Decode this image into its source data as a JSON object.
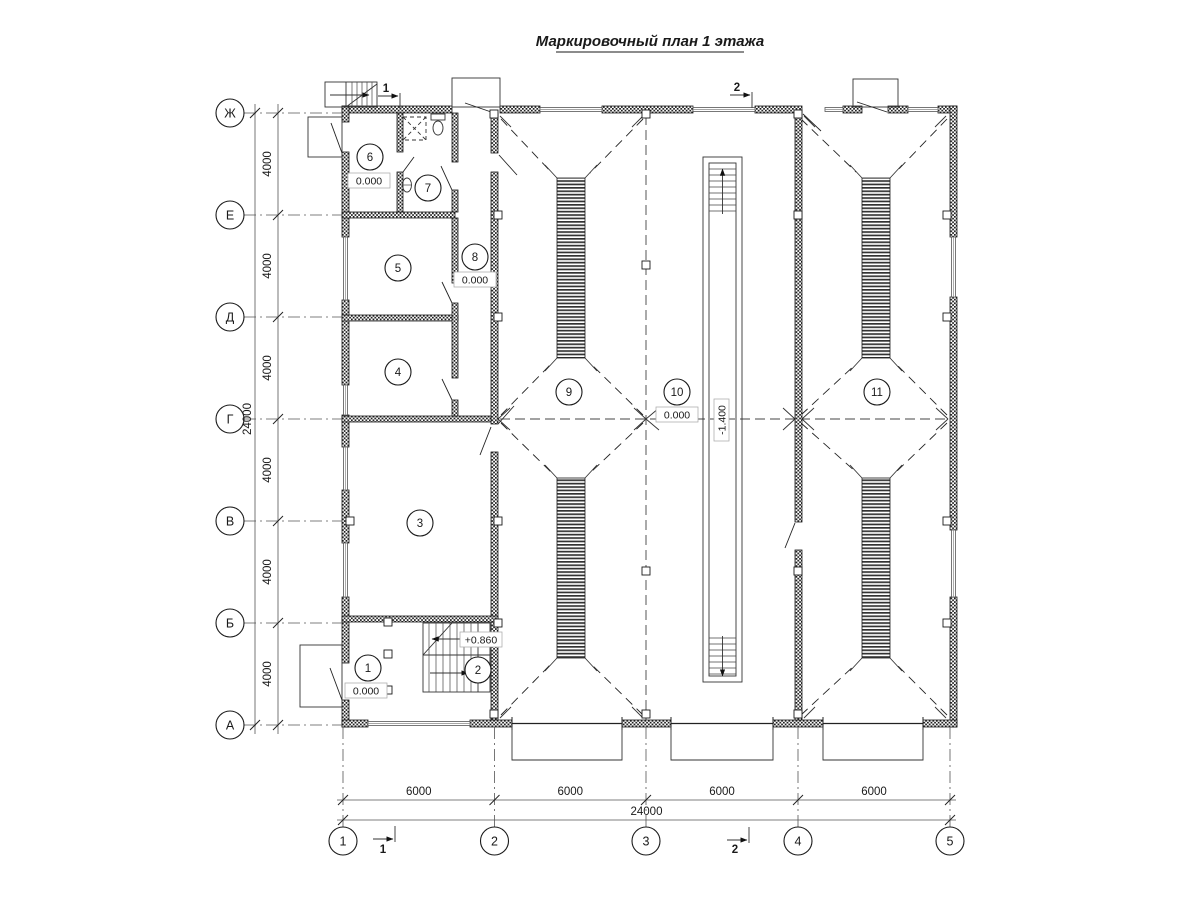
{
  "palette": {
    "ink": "#1a1a1a",
    "background": "#ffffff"
  },
  "title": "Маркировочный план 1 этажа",
  "grid": {
    "row_axes": [
      {
        "label": "Ж",
        "y": 113
      },
      {
        "label": "Е",
        "y": 215
      },
      {
        "label": "Д",
        "y": 317
      },
      {
        "label": "Г",
        "y": 419
      },
      {
        "label": "В",
        "y": 521
      },
      {
        "label": "Б",
        "y": 623
      },
      {
        "label": "А",
        "y": 725
      }
    ],
    "col_axes": [
      {
        "label": "1",
        "x": 343
      },
      {
        "label": "2",
        "x": 494.5
      },
      {
        "label": "3",
        "x": 646
      },
      {
        "label": "4",
        "x": 798
      },
      {
        "label": "5",
        "x": 950
      }
    ]
  },
  "dimensions": {
    "left_segments": [
      "4000",
      "4000",
      "4000",
      "4000",
      "4000",
      "4000"
    ],
    "left_total": "24000",
    "bottom_segments": [
      "6000",
      "6000",
      "6000",
      "6000"
    ],
    "bottom_total": "24000"
  },
  "rooms": [
    {
      "number": "1",
      "x": 368,
      "y": 668
    },
    {
      "number": "2",
      "x": 478,
      "y": 670
    },
    {
      "number": "3",
      "x": 420,
      "y": 523
    },
    {
      "number": "4",
      "x": 398,
      "y": 372
    },
    {
      "number": "5",
      "x": 398,
      "y": 268
    },
    {
      "number": "6",
      "x": 370,
      "y": 157
    },
    {
      "number": "7",
      "x": 428,
      "y": 188
    },
    {
      "number": "8",
      "x": 475,
      "y": 257
    },
    {
      "number": "9",
      "x": 569,
      "y": 392
    },
    {
      "number": "10",
      "x": 677,
      "y": 392
    },
    {
      "number": "11",
      "x": 877,
      "y": 392
    }
  ],
  "elevations": [
    {
      "text": "0.000",
      "x": 369,
      "y": 181,
      "rotated": false
    },
    {
      "text": "0.000",
      "x": 475,
      "y": 280,
      "rotated": false
    },
    {
      "text": "0.000",
      "x": 366,
      "y": 691,
      "rotated": false
    },
    {
      "text": "+0.860",
      "x": 481,
      "y": 640,
      "rotated": false
    },
    {
      "text": "0.000",
      "x": 677,
      "y": 415,
      "rotated": false
    },
    {
      "text": "-1.400",
      "x": 722,
      "y": 420,
      "rotated": true
    }
  ],
  "section_marks": [
    {
      "label": "1",
      "tip_x": 398,
      "y": 96,
      "text_x": 386,
      "text_y": 92,
      "bar": "down"
    },
    {
      "label": "2",
      "tip_x": 750,
      "y": 95,
      "text_x": 737,
      "text_y": 91,
      "bar": "down"
    },
    {
      "label": "1",
      "tip_x": 393,
      "y": 839,
      "text_x": 383,
      "text_y": 853,
      "bar": "up"
    },
    {
      "label": "2",
      "tip_x": 747,
      "y": 840,
      "text_x": 735,
      "text_y": 853,
      "bar": "up"
    }
  ]
}
